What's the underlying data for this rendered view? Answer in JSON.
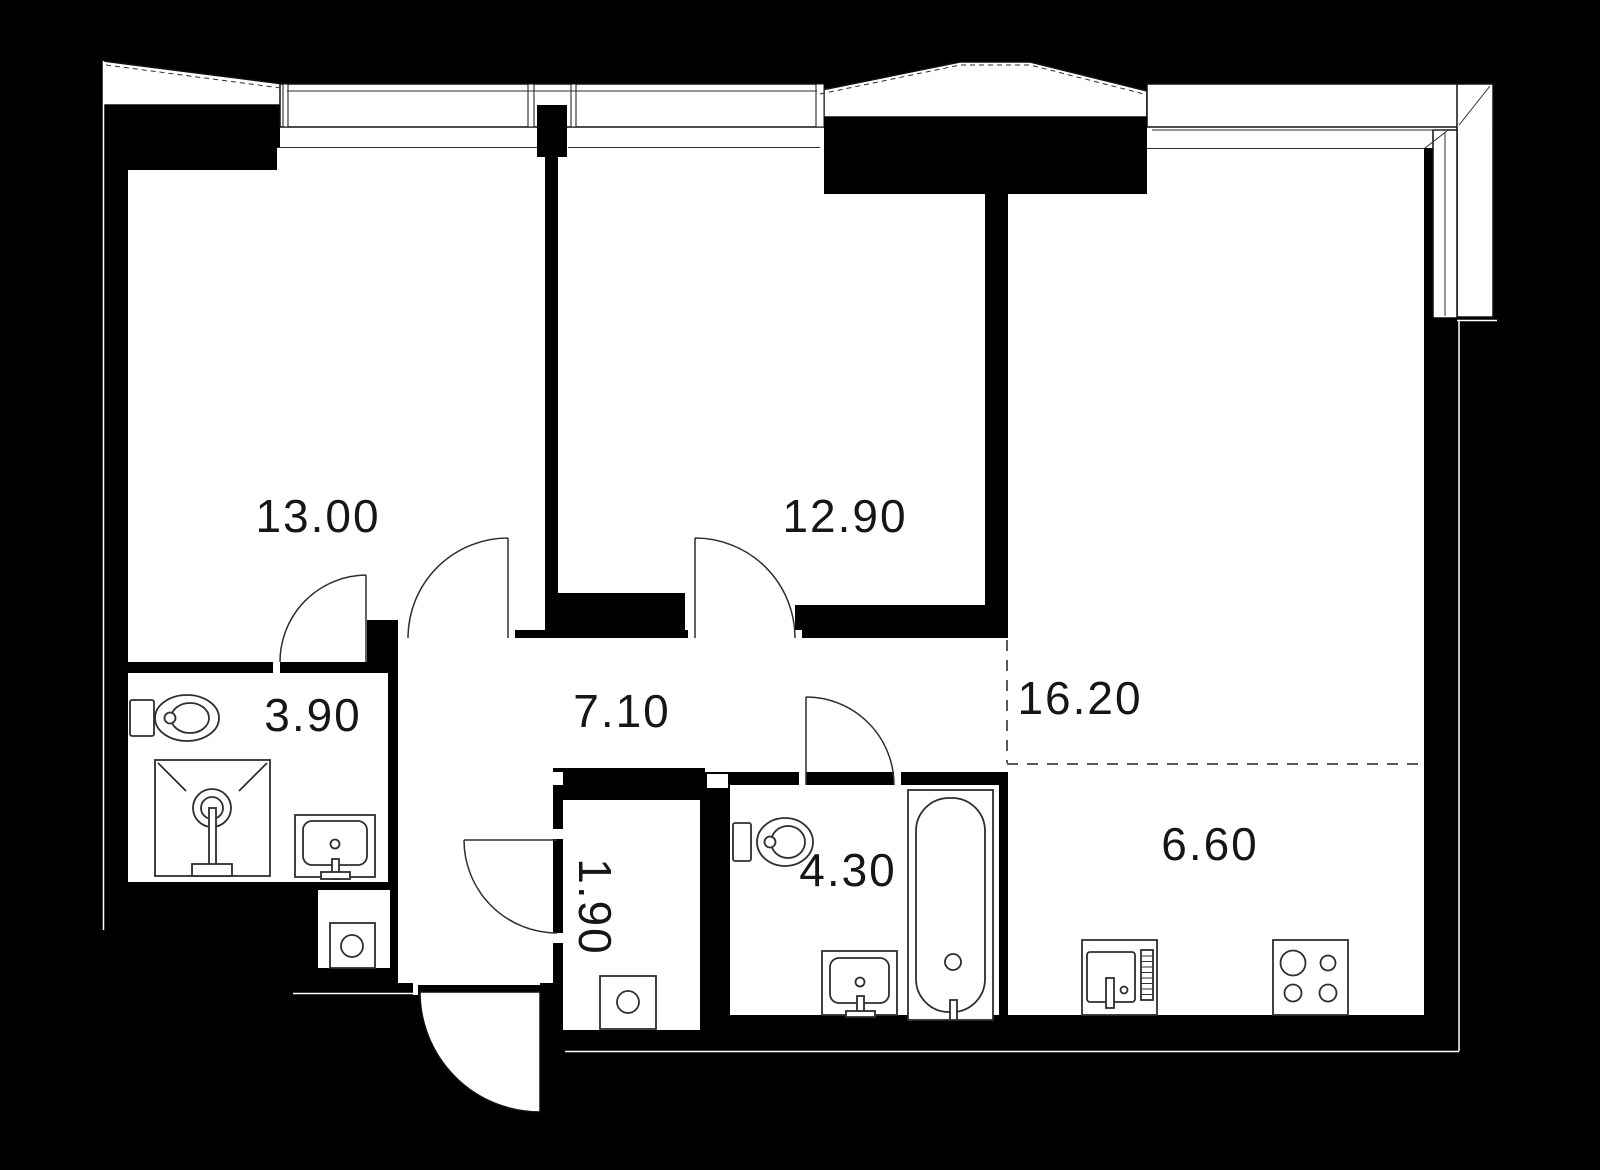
{
  "rooms": [
    {
      "name": "bedroom-1",
      "area_label": "13.00"
    },
    {
      "name": "bedroom-2",
      "area_label": "12.90"
    },
    {
      "name": "living-room",
      "area_label": "16.20"
    },
    {
      "name": "bathroom-1",
      "area_label": "3.90"
    },
    {
      "name": "hallway",
      "area_label": "7.10"
    },
    {
      "name": "wardrobe",
      "area_label": "1.90"
    },
    {
      "name": "bathroom-2",
      "area_label": "4.30"
    },
    {
      "name": "kitchen",
      "area_label": "6.60"
    }
  ],
  "colors": {
    "background": "#000000",
    "floor": "#ffffff",
    "wall": "#000000",
    "fixture_line": "#2e2e2e",
    "label": "#161616"
  }
}
